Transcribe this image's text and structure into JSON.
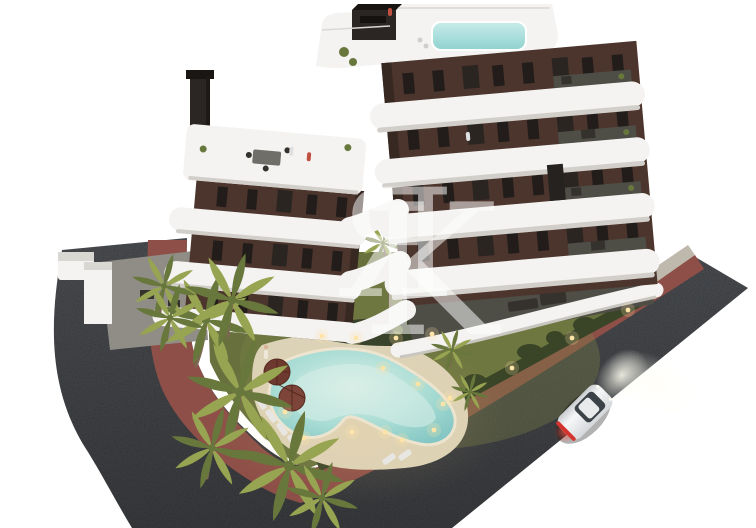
{
  "scene": {
    "description": "Aerial dusk 3D architectural render of a modern apartment building with curved white balcony bands and dark brown brick facade, rooftop pool, landscaped garden with free-form lit swimming pool, sun loungers and umbrellas, palm trees, dark perimeter roads with red sidewalk strip, and a single white car driving on the right road",
    "watermark": {
      "monogram": "ЯK",
      "letter_r": "Я",
      "letter_k": "K"
    },
    "objects": [
      "apartment-building",
      "rooftop-pool",
      "roof-terrace",
      "balcony-bands",
      "facade-windows",
      "garden-lawn",
      "swimming-pool",
      "pool-deck",
      "sun-umbrellas",
      "sun-loungers",
      "palm-trees",
      "hedge",
      "perimeter-wall",
      "ground-terraces",
      "left-road",
      "right-road",
      "red-sidewalk-strip",
      "curb",
      "white-car",
      "garden-lights"
    ]
  },
  "colors": {
    "background": "#ffffff",
    "asphalt": "#33363b",
    "asphalt_dark": "#25272b",
    "sidewalk_red": "#8d4f47",
    "curb_gray": "#beb8ad",
    "edging": "#cfc7b6",
    "lawn": "#68713d",
    "lawn_light": "#7d8449",
    "hedge": "#3a4527",
    "deck_sand": "#dcd2b7",
    "pool_water": "#8fcdc8",
    "pool_light": "#d9efe7",
    "wall_brown": "#4c352c",
    "wall_shadow": "#382822",
    "band_white": "#f4f3f1",
    "band_shadow": "#d2cfca",
    "terrace_floor": "#4e4d46",
    "window_dark": "#221d1a",
    "glass": "#8b9398",
    "palm_light": "#97a451",
    "palm_dark": "#68783c",
    "trunk": "#7b6850",
    "car_body": "#eef0f2",
    "taillight": "#d5342e",
    "glow_warm": "#ffe4a8",
    "watermark": "#ffffff"
  }
}
